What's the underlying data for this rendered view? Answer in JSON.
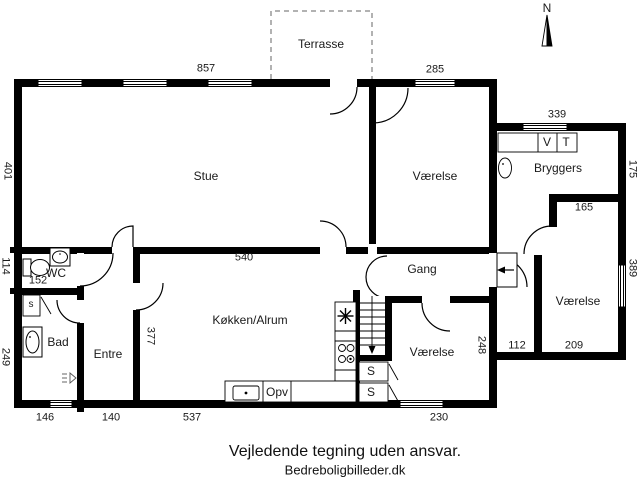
{
  "footer": {
    "disclaimer": "Vejledende tegning uden ansvar.",
    "credit": "Bedreboligbilleder.dk"
  },
  "colors": {
    "wall": "#000000",
    "background": "#ffffff",
    "terrace_dash": "#999999",
    "text": "#1a1a1a"
  },
  "floorplan": {
    "compass": "N",
    "terrace_label": "Terrasse",
    "rooms": [
      "Stue",
      "Værelse",
      "Bryggers",
      "Værelse",
      "Gang",
      "Køkken/Alrum",
      "Værelse",
      "Entre",
      "Bad",
      "WC"
    ],
    "dimensions_cm": [
      "857",
      "285",
      "339",
      "401",
      "114",
      "249",
      "152",
      "146",
      "140",
      "537",
      "230",
      "540",
      "377",
      "248",
      "112",
      "209",
      "165",
      "175",
      "389"
    ],
    "labels": [
      {
        "id": "dim-857",
        "text": "857",
        "x": 206,
        "y": 69,
        "rot": 0,
        "cls": "dim"
      },
      {
        "id": "dim-285",
        "text": "285",
        "x": 435,
        "y": 70,
        "rot": 0,
        "cls": "dim"
      },
      {
        "id": "dim-339",
        "text": "339",
        "x": 557,
        "y": 115,
        "rot": 0,
        "cls": "dim"
      },
      {
        "id": "dim-401",
        "text": "401",
        "x": 7,
        "y": 171,
        "rot": 1,
        "cls": "dim"
      },
      {
        "id": "dim-114",
        "text": "114",
        "x": 5,
        "y": 266,
        "rot": 1,
        "cls": "dim"
      },
      {
        "id": "dim-249",
        "text": "249",
        "x": 5,
        "y": 357,
        "rot": 1,
        "cls": "dim"
      },
      {
        "id": "dim-152",
        "text": "152",
        "x": 38,
        "y": 281,
        "rot": 0,
        "cls": "dim"
      },
      {
        "id": "dim-146",
        "text": "146",
        "x": 45,
        "y": 418,
        "rot": 0,
        "cls": "dim"
      },
      {
        "id": "dim-140",
        "text": "140",
        "x": 111,
        "y": 418,
        "rot": 0,
        "cls": "dim"
      },
      {
        "id": "dim-537",
        "text": "537",
        "x": 192,
        "y": 418,
        "rot": 0,
        "cls": "dim"
      },
      {
        "id": "dim-230",
        "text": "230",
        "x": 439,
        "y": 418,
        "rot": 0,
        "cls": "dim"
      },
      {
        "id": "dim-540",
        "text": "540",
        "x": 244,
        "y": 258,
        "rot": 0,
        "cls": "dim"
      },
      {
        "id": "dim-377",
        "text": "377",
        "x": 150,
        "y": 336,
        "rot": 1,
        "cls": "dim"
      },
      {
        "id": "dim-248",
        "text": "248",
        "x": 481,
        "y": 345,
        "rot": 1,
        "cls": "dim"
      },
      {
        "id": "dim-112",
        "text": "112",
        "x": 517,
        "y": 346,
        "rot": 0,
        "cls": "dim"
      },
      {
        "id": "dim-209",
        "text": "209",
        "x": 574,
        "y": 346,
        "rot": 0,
        "cls": "dim"
      },
      {
        "id": "dim-165",
        "text": "165",
        "x": 584,
        "y": 208,
        "rot": 0,
        "cls": "dim"
      },
      {
        "id": "dim-175",
        "text": "175",
        "x": 632,
        "y": 169,
        "rot": 1,
        "cls": "dim"
      },
      {
        "id": "dim-389",
        "text": "389",
        "x": 632,
        "y": 268,
        "rot": 1,
        "cls": "dim"
      },
      {
        "id": "room-stue",
        "text": "Stue",
        "x": 206,
        "y": 176,
        "rot": 0,
        "cls": "room"
      },
      {
        "id": "room-vaerelse-nord",
        "text": "Værelse",
        "x": 435,
        "y": 176,
        "rot": 0,
        "cls": "room"
      },
      {
        "id": "room-bryggers",
        "text": "Bryggers",
        "x": 558,
        "y": 168,
        "rot": 0,
        "cls": "room"
      },
      {
        "id": "room-vaerelse-oest",
        "text": "Værelse",
        "x": 578,
        "y": 301,
        "rot": 0,
        "cls": "room"
      },
      {
        "id": "room-gang",
        "text": "Gang",
        "x": 422,
        "y": 269,
        "rot": 0,
        "cls": "room"
      },
      {
        "id": "room-koekken-alrum",
        "text": "Køkken/Alrum",
        "x": 250,
        "y": 320,
        "rot": 0,
        "cls": "room"
      },
      {
        "id": "room-vaerelse-syd",
        "text": "Værelse",
        "x": 432,
        "y": 352,
        "rot": 0,
        "cls": "room"
      },
      {
        "id": "room-entre",
        "text": "Entre",
        "x": 108,
        "y": 354,
        "rot": 0,
        "cls": "room"
      },
      {
        "id": "room-bad",
        "text": "Bad",
        "x": 58,
        "y": 342,
        "rot": 0,
        "cls": "room"
      },
      {
        "id": "room-wc",
        "text": "WC",
        "x": 56,
        "y": 273,
        "rot": 0,
        "cls": "room"
      },
      {
        "id": "label-terrasse",
        "text": "Terrasse",
        "x": 321,
        "y": 44,
        "rot": 0,
        "cls": "room"
      },
      {
        "id": "label-opv",
        "text": "Opv",
        "x": 277,
        "y": 392,
        "rot": 0,
        "cls": "small"
      },
      {
        "id": "label-appliance-v",
        "text": "V",
        "x": 547,
        "y": 142,
        "rot": 0,
        "cls": "small"
      },
      {
        "id": "label-appliance-t",
        "text": "T",
        "x": 566,
        "y": 142,
        "rot": 0,
        "cls": "small"
      },
      {
        "id": "label-closet-s-bad",
        "text": "s",
        "x": 31,
        "y": 305,
        "rot": 0,
        "cls": "tiny"
      },
      {
        "id": "label-closet-s-1",
        "text": "S",
        "x": 371,
        "y": 371,
        "rot": 0,
        "cls": "small"
      },
      {
        "id": "label-closet-s-2",
        "text": "S",
        "x": 371,
        "y": 392,
        "rot": 0,
        "cls": "small"
      },
      {
        "id": "compass-n-label",
        "text": "N",
        "x": 547,
        "y": 8,
        "rot": 0,
        "cls": "room"
      }
    ]
  }
}
